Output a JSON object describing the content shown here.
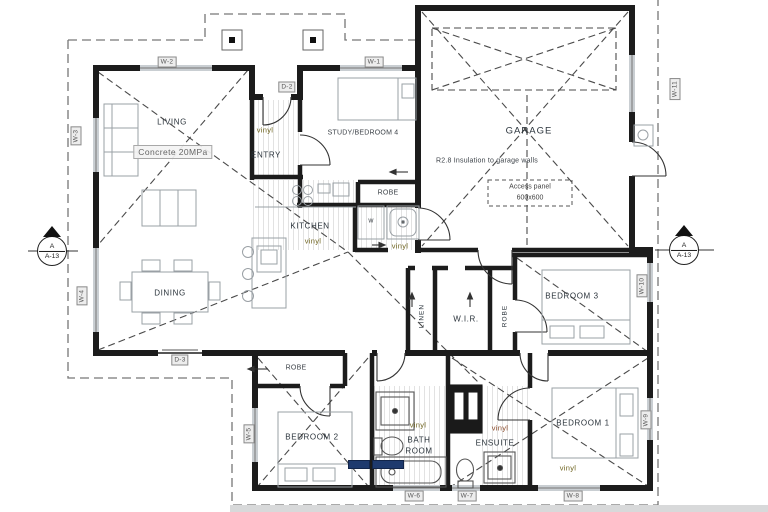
{
  "plan": {
    "rooms": {
      "living": "LIVING",
      "entry": "ENTRY",
      "kitchen": "KITCHEN",
      "dining": "DINING",
      "study": "STUDY/BEDROOM 4",
      "garage": "GARAGE",
      "bedroom3": "BEDROOM 3",
      "wir": "W.I.R.",
      "linen": "LINEN",
      "robe": "ROBE",
      "bedroom2": "BEDROOM 2",
      "bathroom_line1": "BATH",
      "bathroom_line2": "ROOM",
      "ensuite": "ENSUITE",
      "bedroom1": "BEDROOM 1"
    },
    "finishes": {
      "concrete": "Concrete 20MPa",
      "vinyl": "vinyl",
      "washer": "w"
    },
    "annotations": {
      "garage_insulation": "R2.8 Insulation to garage walls",
      "access_panel_line1": "Access panel",
      "access_panel_line2": "600x600"
    },
    "section_marker": {
      "letter": "A",
      "sheet": "A-13"
    },
    "tags": {
      "w1": "W-1",
      "w2": "W-2",
      "w3": "W-3",
      "w4": "W-4",
      "w5": "W-5",
      "w6": "W-6",
      "w7": "W-7",
      "w8": "W-8",
      "w9": "W-9",
      "w10": "W-10",
      "w11": "W-11",
      "d2": "D-2",
      "d3": "D-3"
    },
    "colors": {
      "wall": "#1c1c1c",
      "window": "#c9ced2",
      "vinyl_text": "#6f6420",
      "chip": "#1e3a6e",
      "dash": "#555555"
    }
  }
}
